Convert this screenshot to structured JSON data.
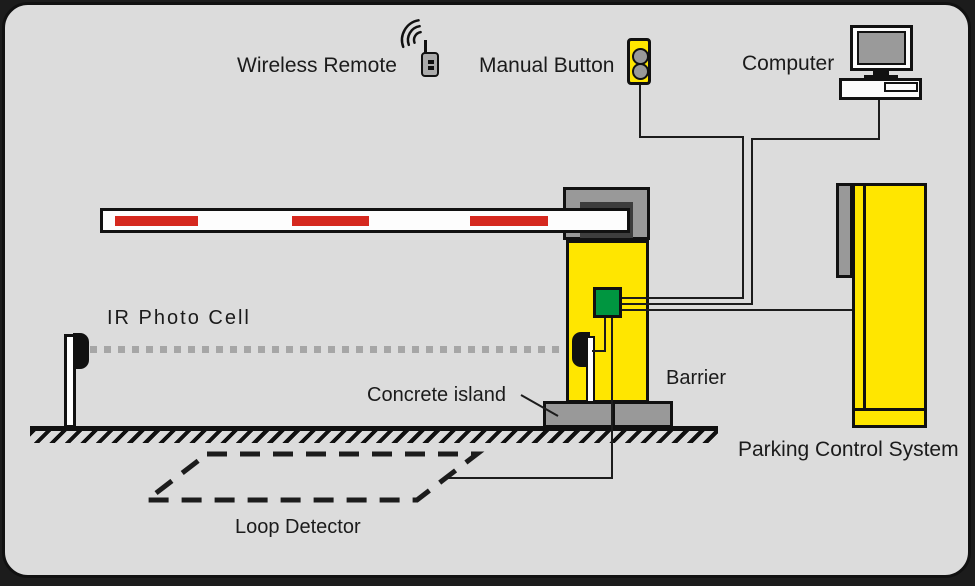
{
  "labels": {
    "wireless_remote": "Wireless Remote",
    "manual_button": "Manual Button",
    "computer": "Computer",
    "ir_photo_cell": "IR Photo Cell",
    "concrete_island": "Concrete island",
    "barrier": "Barrier",
    "parking_control_system": "Parking Control System",
    "loop_detector": "Loop Detector"
  },
  "icons": {
    "wireless-remote-icon": "handheld remote with antenna and signal waves",
    "manual-button-icon": "yellow box with two round push buttons",
    "computer-icon": "desktop monitor with system unit",
    "barrier-arm": "white boom with red stripes",
    "barrier-post-icon": "yellow barrier housing with gray cap",
    "control-unit-icon": "green box inside barrier post",
    "ir-photocell-transmitter-icon": "post with black sensor head",
    "ir-photocell-receiver-icon": "black sensor head on barrier post",
    "ir-beam": "gray dotted line",
    "concrete-island-icon": "gray block on ground",
    "ground-icon": "hatched ground line",
    "loop-detector-icon": "dashed parallelogram in roadway",
    "parking-cabinet-icon": "yellow control cabinet"
  },
  "colors": {
    "canvas-bg": "#dcdcdc",
    "outline": "#111111",
    "yellow": "#ffe600",
    "red": "#d5281e",
    "green": "#009640",
    "gray-device": "#999999",
    "beam-gray": "#a6a6a6",
    "wire": "#1c1c1c"
  }
}
